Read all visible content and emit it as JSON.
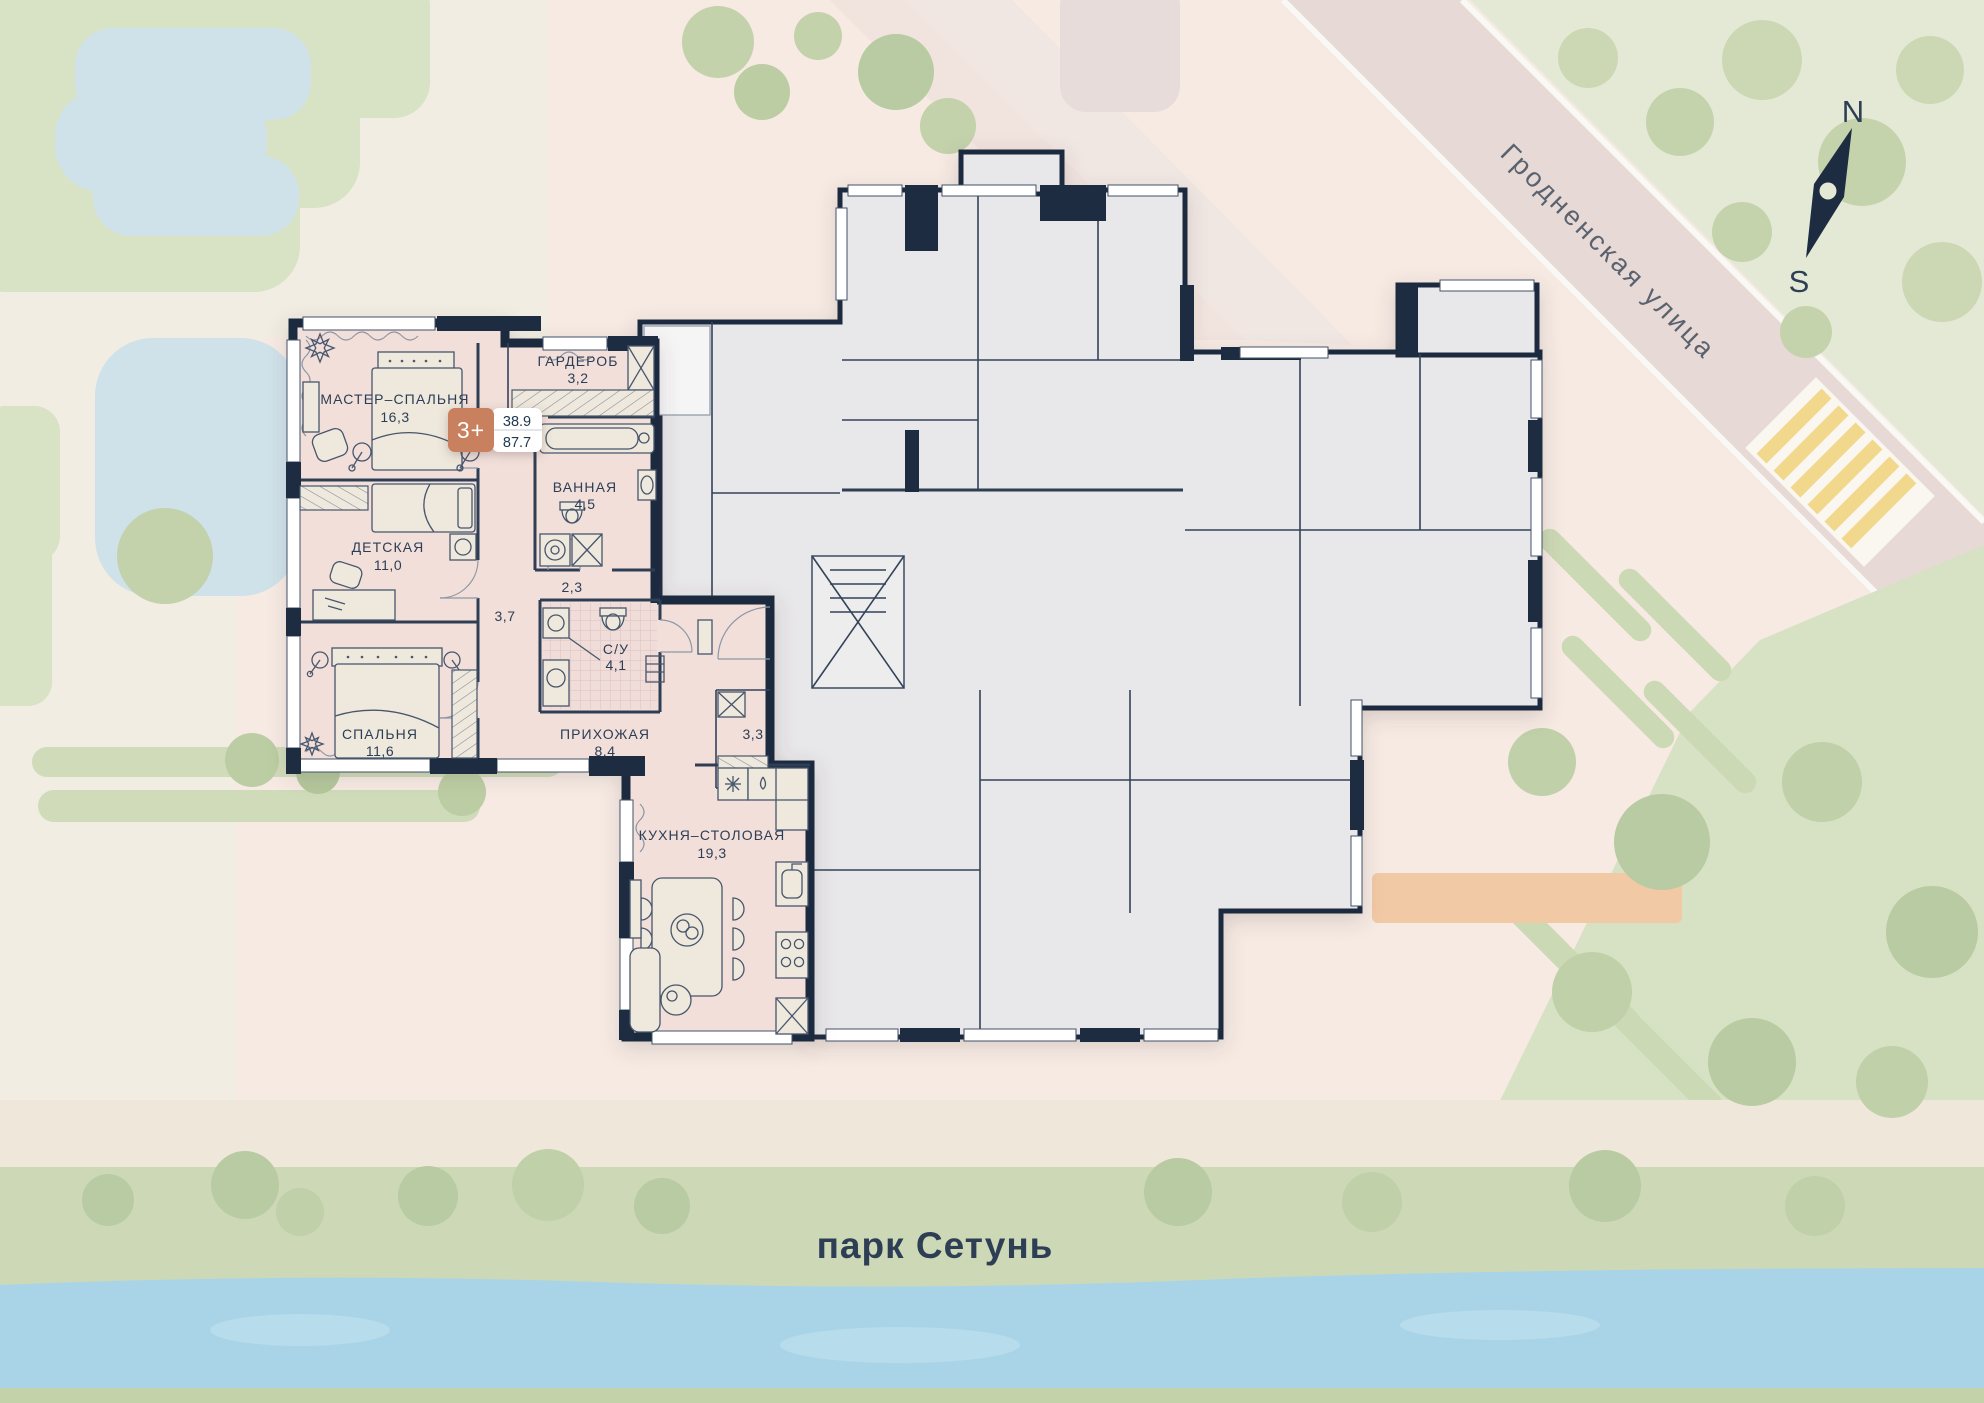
{
  "site": {
    "street": "Гродненская улица",
    "park": "парк Сетунь",
    "compass_n": "N",
    "compass_s": "S"
  },
  "unit": {
    "badge": "3+",
    "area_living": "38.9",
    "area_total": "87.7",
    "badge_color": "#c8805f",
    "unit_fill": "#f2dfda",
    "wall_color": "#1d2c41"
  },
  "rooms": {
    "master": {
      "name": "МАСТЕР–СПАЛЬНЯ",
      "area": "16,3"
    },
    "wardrobe": {
      "name": "ГАРДЕРОБ",
      "area": "3,2"
    },
    "bath": {
      "name": "ВАННАЯ",
      "area": "4,5"
    },
    "kids": {
      "name": "ДЕТСКАЯ",
      "area": "11,0"
    },
    "bedroom": {
      "name": "СПАЛЬНЯ",
      "area": "11,6"
    },
    "hall": {
      "name": "ПРИХОЖАЯ",
      "area": "8,4"
    },
    "wc": {
      "name": "С/У",
      "area": "4,1"
    },
    "kitchen": {
      "name": "КУХНЯ–СТОЛОВАЯ",
      "area": "19,3"
    },
    "corridor_37": "3,7",
    "niche_23": "2,3",
    "storage_33": "3,3"
  }
}
